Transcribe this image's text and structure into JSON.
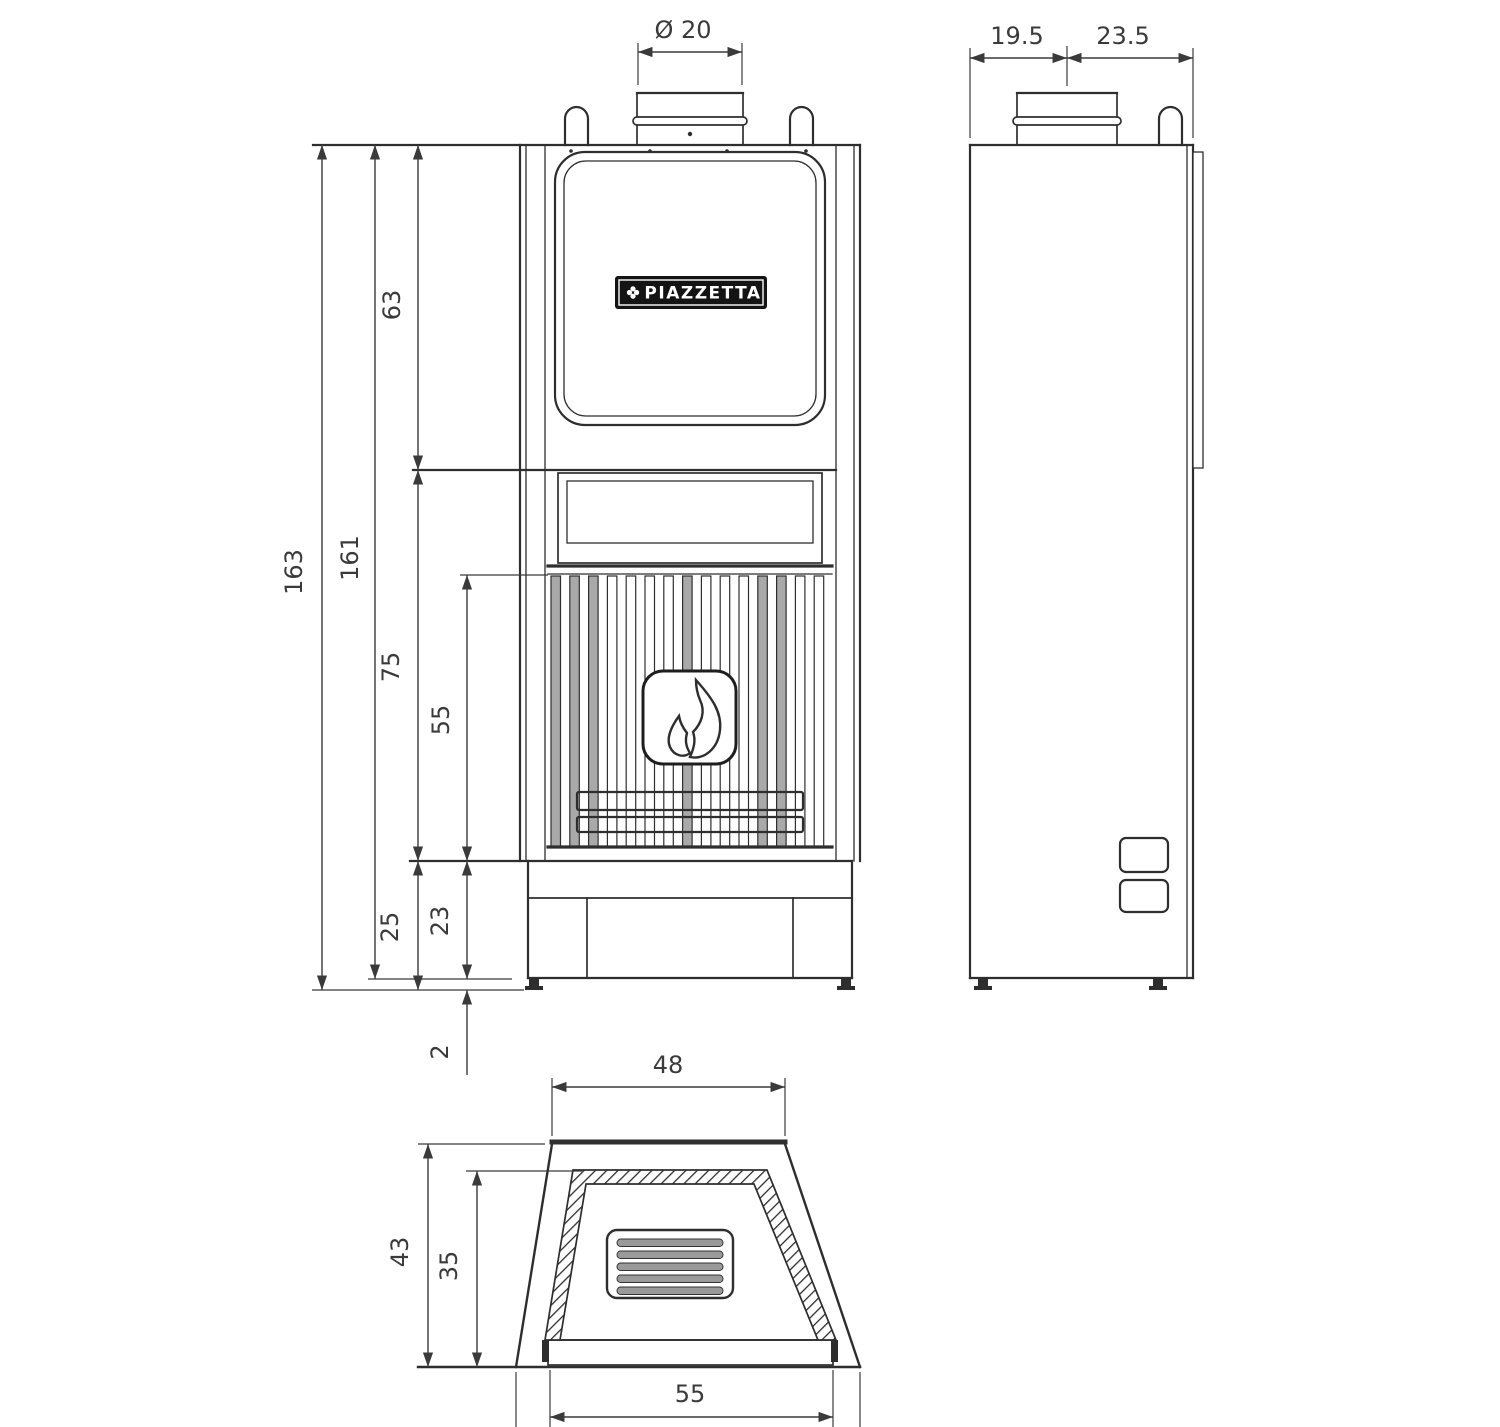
{
  "logo": {
    "text": "PIAZZETTA"
  },
  "front_view": {
    "flue_diameter": "Ø 20",
    "total_height": "163",
    "body_height": "161",
    "upper_section_height": "63",
    "firebox_section_height": "75",
    "grille_height": "55",
    "plinth_with_feet_height": "25",
    "plinth_height": "23",
    "feet_height": "2"
  },
  "side_view": {
    "flue_offset_front": "19.5",
    "flue_offset_rear": "23.5"
  },
  "top_view": {
    "top_width": "48",
    "total_depth": "43",
    "inner_depth": "35",
    "base_width": "55"
  },
  "colors": {
    "line": "#2e2e2e",
    "dimension": "#3a3a3a",
    "grille_bar_fill": "#a9a9a9",
    "louver_slat_fill": "#9a9a9a",
    "logo_background": "#141414",
    "logo_text": "#ffffff",
    "background": "#ffffff"
  }
}
